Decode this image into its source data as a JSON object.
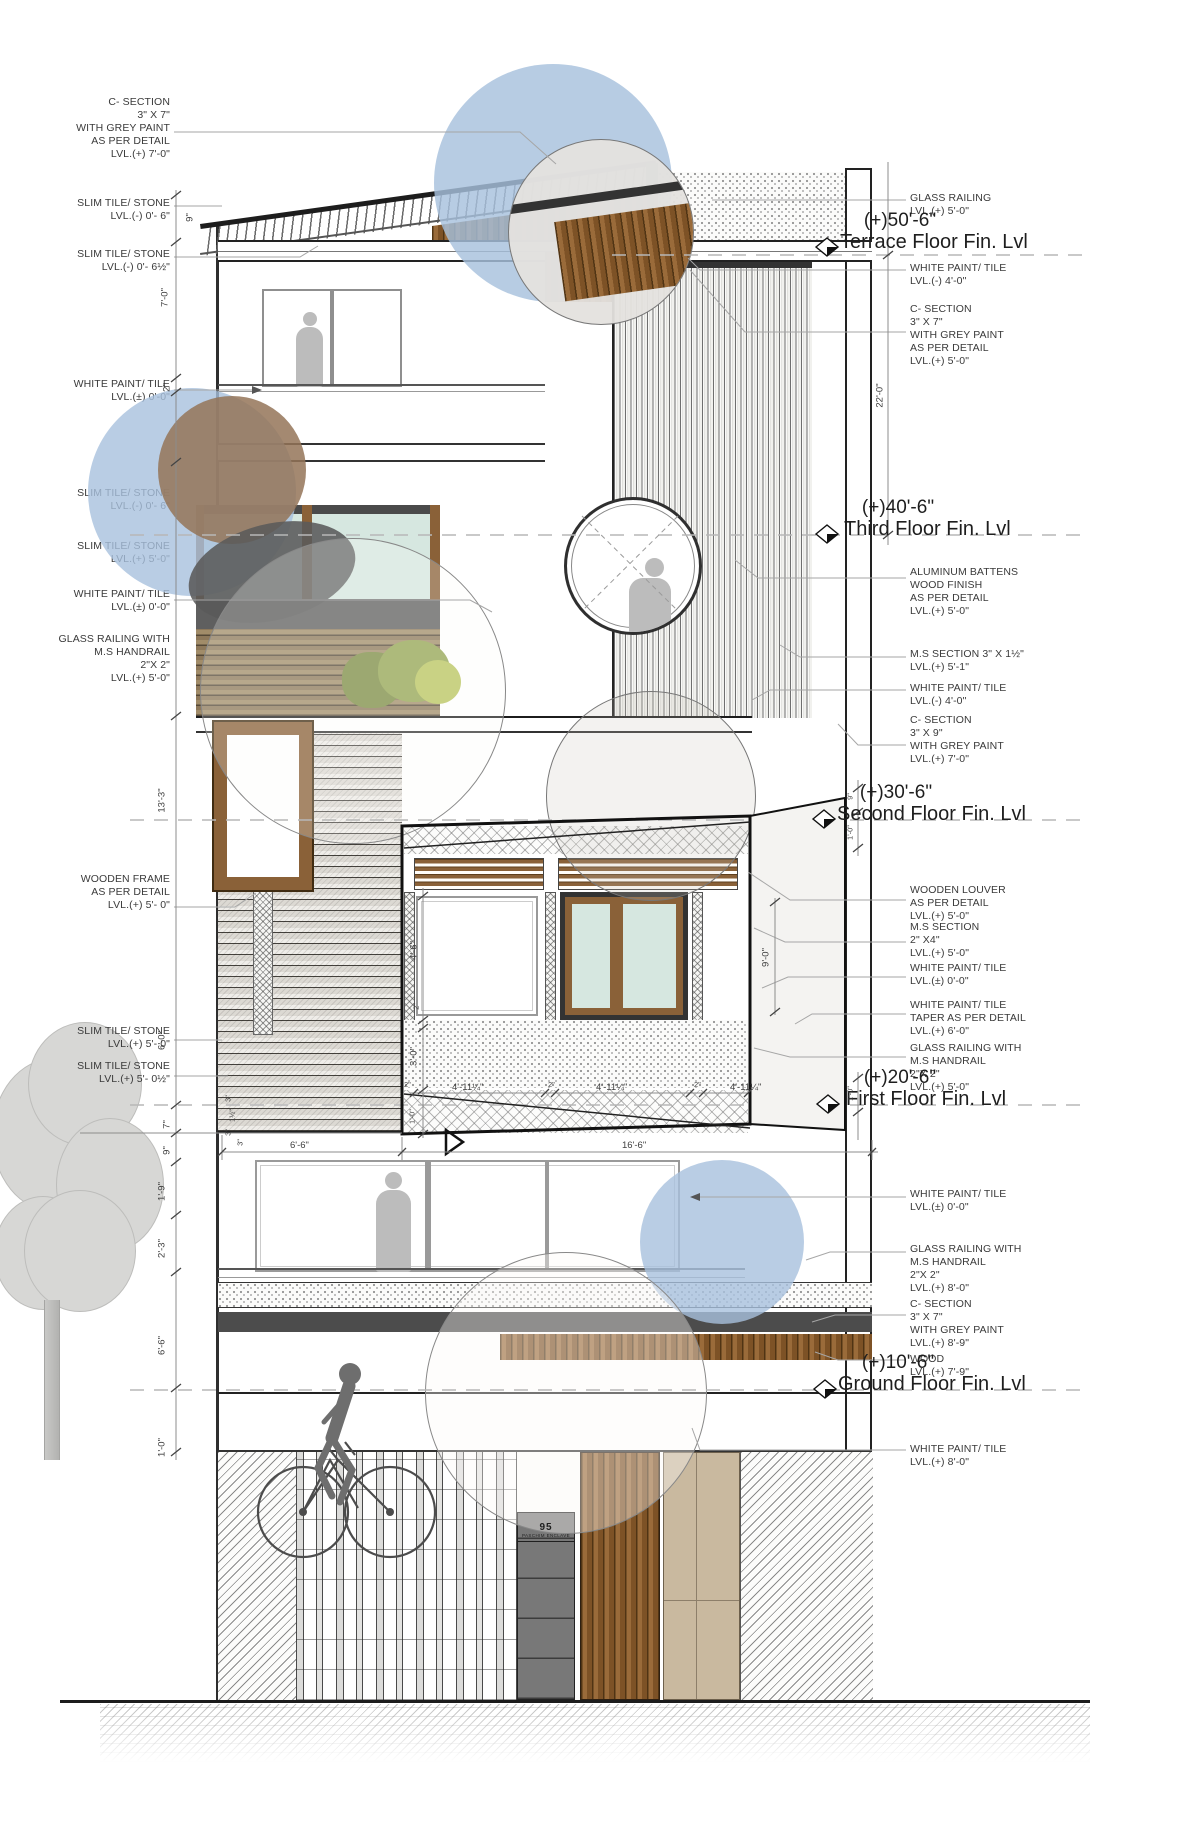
{
  "levels": [
    {
      "elev": "(+)50'-6\"",
      "name": "Terrace Floor Fin. Lvl"
    },
    {
      "elev": "(+)40'-6\"",
      "name": "Third Floor Fin. Lvl"
    },
    {
      "elev": "(+)30'-6\"",
      "name": "Second Floor Fin. Lvl"
    },
    {
      "elev": "(+)20'-6\"",
      "name": "First Floor Fin. Lvl"
    },
    {
      "elev": "(+)10'-6\"",
      "name": "Ground Floor Fin. Lvl"
    }
  ],
  "left_annotations": [
    {
      "text": "C- SECTION\n3\" X 7\"\nWITH GREY PAINT\nAS PER DETAIL\nLVL.(+) 7'-0\""
    },
    {
      "text": "SLIM TILE/ STONE\nLVL.(-) 0'- 6\""
    },
    {
      "text": "SLIM TILE/ STONE\nLVL.(-) 0'- 6½\""
    },
    {
      "text": "WHITE PAINT/ TILE\nLVL.(±) 0'-0\""
    },
    {
      "text": "SLIM TILE/ STONE\nLVL.(-) 0'- 6\""
    },
    {
      "text": "SLIM TILE/ STONE\nLVL.(+) 5'-0\""
    },
    {
      "text": "WHITE PAINT/ TILE\nLVL.(±) 0'-0\""
    },
    {
      "text": "GLASS RAILING WITH\nM.S HANDRAIL\n2\"X 2\"\nLVL.(+) 5'-0\""
    },
    {
      "text": "WOODEN FRAME\nAS PER DETAIL\nLVL.(+) 5'- 0\""
    },
    {
      "text": "SLIM TILE/ STONE\nLVL.(+) 5'- 0\""
    },
    {
      "text": "SLIM TILE/ STONE\nLVL.(+) 5'- 0½\""
    }
  ],
  "right_annotations": [
    {
      "text": "GLASS RAILING\nLVL.(+) 5'-0\""
    },
    {
      "text": "WHITE PAINT/ TILE\nLVL.(-) 4'-0\""
    },
    {
      "text": "C- SECTION\n3\" X 7\"\nWITH GREY PAINT\nAS PER DETAIL\nLVL.(+) 5'-0\""
    },
    {
      "text": "ALUMINUM BATTENS\nWOOD FINISH\nAS PER DETAIL\nLVL.(+) 5'-0\""
    },
    {
      "text": "M.S SECTION 3\" X 1½\"\nLVL.(+) 5'-1\""
    },
    {
      "text": "WHITE PAINT/ TILE\nLVL.(-) 4'-0\""
    },
    {
      "text": "C- SECTION\n3\" X 9\"\nWITH GREY PAINT\nLVL.(+) 7'-0\""
    },
    {
      "text": "WOODEN LOUVER\nAS PER DETAIL\nLVL.(+) 5'-0\""
    },
    {
      "text": "M.S SECTION\n2\" X4\"\nLVL.(+) 5'-0\""
    },
    {
      "text": "WHITE PAINT/ TILE\nLVL.(±) 0'-0\""
    },
    {
      "text": "WHITE PAINT/ TILE\nTAPER AS  PER DETAIL\nLVL.(+) 6'-0\""
    },
    {
      "text": "GLASS RAILING WITH\nM.S HANDRAIL\n2\"X 2\"\nLVL.(+) 5'-0\""
    },
    {
      "text": "WHITE PAINT/ TILE\nLVL.(±) 0'-0\""
    },
    {
      "text": "GLASS RAILING WITH\nM.S HANDRAIL\n2\"X 2\"\nLVL.(+) 8'-0\""
    },
    {
      "text": "C- SECTION\n3\" X 7\"\nWITH GREY PAINT\nLVL.(+) 8'-9\""
    },
    {
      "text": "WOOD\nLVL.(+) 7'-9\""
    },
    {
      "text": "WHITE PAINT/ TILE\nLVL.(+) 8'-0\""
    }
  ],
  "dims": {
    "roof_9": "9\"",
    "l_7ft": "7'-0\"",
    "l_2in": "2\"",
    "l_13_3": "13'-3\"",
    "l_6ft": "6'-0\"",
    "l_7in": "7\"",
    "l_9in": "9\"",
    "l_1_9": "1'-9\"",
    "l_2_3": "2'-3\"",
    "l_6_6": "6'-6\"",
    "l_1_0": "1'-0\"",
    "r_22": "22'-0\"",
    "r_9in": "9\"",
    "r_1_0a": "1'-0\"",
    "r_9_0": "9'-0\"",
    "r_1_0b": "1'-0\"",
    "b_4_6": "4'-6\"",
    "b_2a": "2\"",
    "b_3_0": "3'-0\"",
    "b_1_0": "1'-0\"",
    "b_411a": "4'-11¼\"",
    "b_411b": "4'-11¼\"",
    "b_411c": "4'-11¼\"",
    "b_2b": "2\"",
    "b_2c": "2\"",
    "b_2d": "2\"",
    "b_6_6": "6'-6\"",
    "b_16_6": "16'-6\"",
    "b_3in": "3\"",
    "s_3a": "3\"",
    "s_1h": "1½\"",
    "s_3b": "3\""
  },
  "sign": {
    "number": "95",
    "line2": "PASCHIM ENCLAVE"
  },
  "colors": {
    "wood": "#8a6138",
    "blue_bubble": "#a7c1dd",
    "teal_glass": "#d6e7e0",
    "dark_band": "#4c4c4c",
    "beige_stone": "#c9b99f",
    "grey_panel": "#787878"
  }
}
